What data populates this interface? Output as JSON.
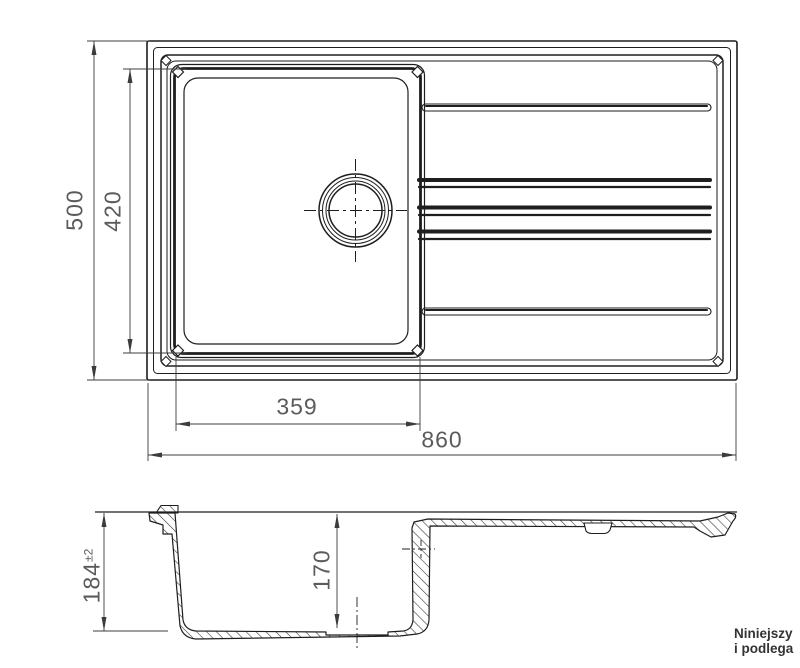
{
  "drawing": {
    "top_view": {
      "dim_height_total": "500",
      "dim_height_basin": "420",
      "dim_width_basin": "359",
      "dim_width_total": "860"
    },
    "section_view": {
      "dim_depth_total": "184",
      "dim_depth_tolerance": "±2",
      "dim_depth_basin": "170"
    },
    "footer_note": {
      "line1": "Niniejszy",
      "line2": "i podlega"
    },
    "colors": {
      "line": "#1e1e1e",
      "dimension_line": "#3c3c3c",
      "dimension_text": "#5b5b5b",
      "note_text": "#333333",
      "background": "#ffffff"
    }
  }
}
